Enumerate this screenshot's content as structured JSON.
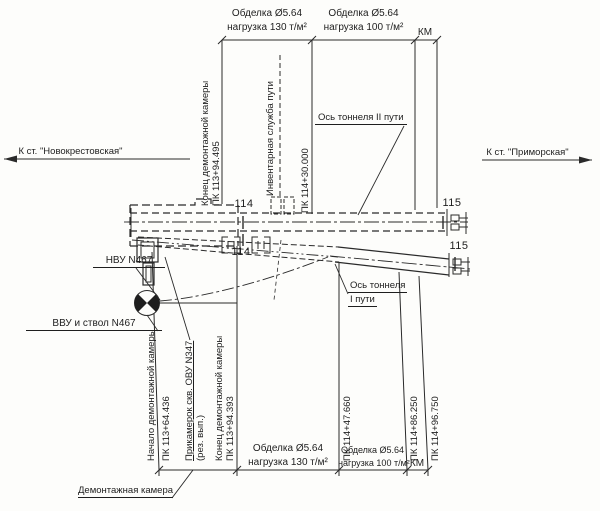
{
  "page": {
    "background": "#fdfdfb",
    "line_color": "#2a2a2a"
  },
  "directions": {
    "left": "К ст. \"Новокрестовская\"",
    "right": "К ст. \"Приморская\""
  },
  "dims_top": {
    "seg1": {
      "l1": "Обделка Ø5.64",
      "l2": "нагрузка 130 т/м²"
    },
    "seg2": {
      "l1": "Обделка Ø5.64",
      "l2": "нагрузка 100 т/м²"
    },
    "km": "КМ"
  },
  "dims_bottom": {
    "seg1": {
      "l1": "Обделка Ø5.64",
      "l2": "нагрузка 130 т/м²"
    },
    "seg2": {
      "l1": "Обделка Ø5.64",
      "l2": "нагрузка 100 т/м²"
    },
    "km": "КМ"
  },
  "stations_top": {
    "end_chamber": {
      "l1": "Конец демонтажной камеры",
      "l2": "ПК 113+94.495"
    },
    "inventory": {
      "l1": "Инвентарная служба пути"
    },
    "pk_114_30": {
      "l1": "ПК 114+30.000"
    }
  },
  "stations_bottom": {
    "start_chamber": {
      "l1": "Начало демонтажной камеры",
      "l2": "ПК 113+64.436"
    },
    "prikamerok": {
      "l1": "Прикамерок скв. ОВУ N347",
      "l2": "(рез. вып.)"
    },
    "end_chamber": {
      "l1": "Конец демонтажной камеры",
      "l2": "ПК 113+94.393"
    },
    "pk_47": {
      "l1": "ПК 114+47.660"
    },
    "pk_86": {
      "l1": "ПК 114+86.250"
    },
    "pk_96": {
      "l1": "ПК 114+96.750"
    }
  },
  "axes": {
    "tunnel2": "Ось тоннеля II пути",
    "tunnel1_l1": "Ось тоннеля",
    "tunnel1_l2": "I пути"
  },
  "pickets": {
    "p114": "114",
    "p115": "115"
  },
  "annotations": {
    "nvu": "НВУ N467",
    "vvu": "ВВУ и ствол N467",
    "chamber": "Демонтажная камера"
  }
}
